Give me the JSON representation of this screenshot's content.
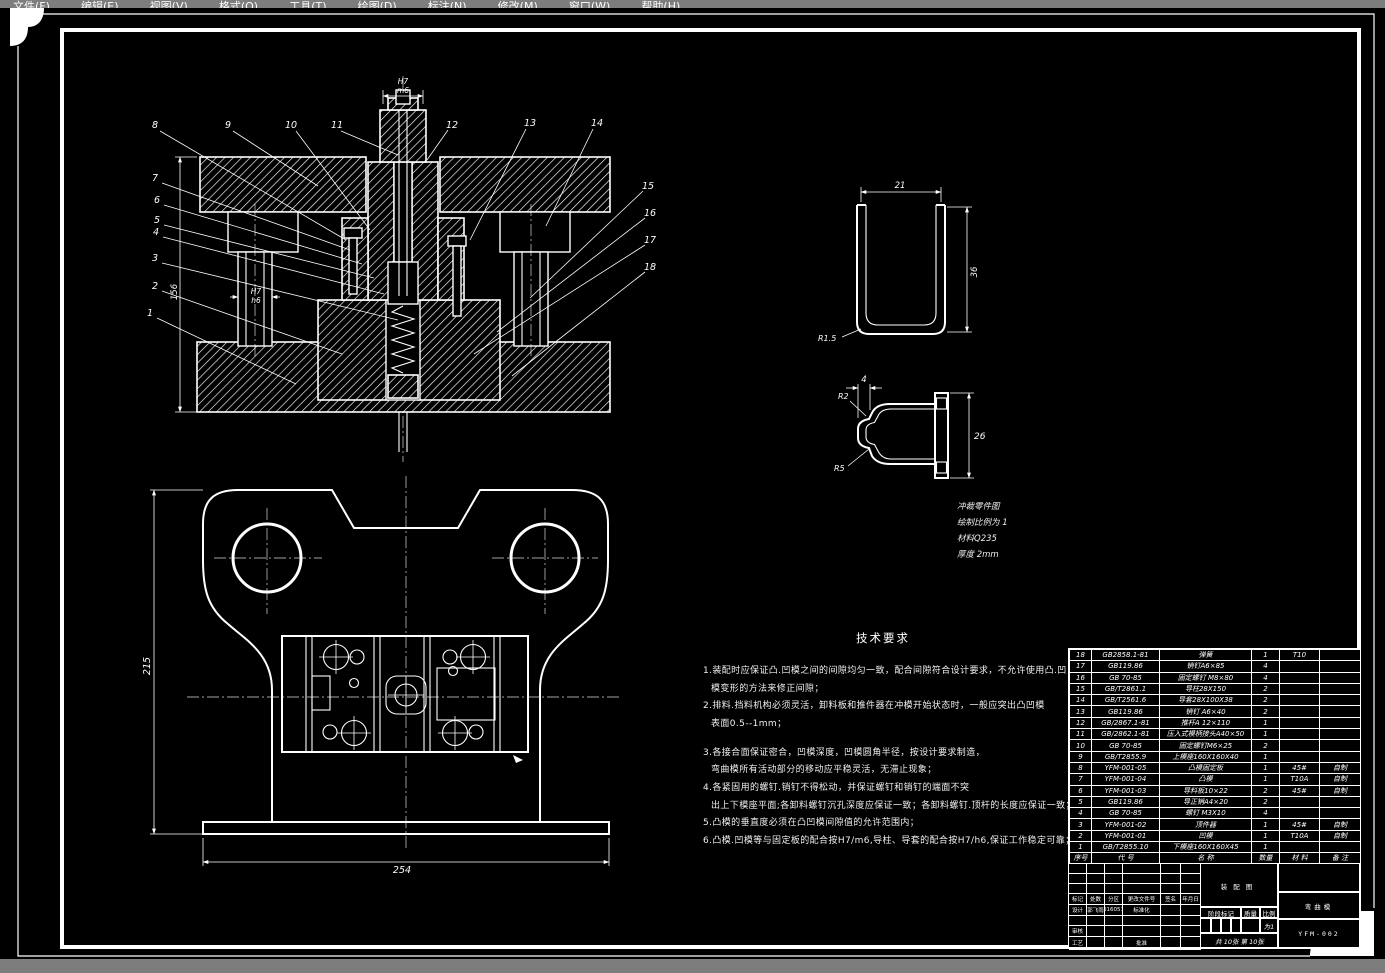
{
  "menu": {
    "items": [
      "文件(F)",
      "编辑(E)",
      "视图(V)",
      "格式(O)",
      "工具(T)",
      "绘图(D)",
      "标注(N)",
      "修改(M)",
      "窗口(W)",
      "帮助(H)"
    ]
  },
  "section_view": {
    "balloons": [
      "1",
      "2",
      "3",
      "4",
      "5",
      "6",
      "7",
      "8",
      "9",
      "10",
      "11",
      "12",
      "13",
      "14",
      "15",
      "16",
      "17",
      "18"
    ],
    "fit_shank_upper": "H7",
    "fit_shank_lower": "m6",
    "fit_pillar_upper": "H7",
    "fit_pillar_lower": "h6",
    "dim_height": "156"
  },
  "plan_view": {
    "dim_height": "215",
    "dim_width": "254"
  },
  "detail_channel": {
    "dim_width": "21",
    "dim_height": "36",
    "radius": "R1.5"
  },
  "detail_cap": {
    "dim_width": "4",
    "radius_top": "R2",
    "radius_bottom": "R5",
    "dim_height": "26"
  },
  "detail_notes": {
    "line1": "冲裁零件图",
    "line2": "绘制比例为 1",
    "line3": "材料Q235",
    "line4": "厚度 2mm"
  },
  "tech_requirements": {
    "title": "技术要求",
    "lines": [
      "1.装配时应保证凸.凹模之间的间隙均匀一致，配合间隙符合设计要求，不允许使用凸.凹",
      "模变形的方法来修正间隙；",
      "2.排料.挡料机构必须灵活，卸料板和推件器在冲模开始状态时，一般应突出凸凹模",
      "表面0.5--1mm；",
      "3.各接合面保证密合，凹模深度，凹模圆角半径，按设计要求制造，",
      "弯曲模所有活动部分的移动应平稳灵活，无滞止现象；",
      "4.各紧固用的螺钉.销钉不得松动，并保证螺钉和销钉的端面不突",
      "出上下模座平面;各卸料螺钉沉孔深度应保证一致；各卸料螺钉.顶杆的长度应保证一致；",
      "5.凸模的垂直度必须在凸凹模间隙值的允许范围内；",
      "6.凸模.凹模等与固定板的配合按H7/m6,导柱、导套的配合按H7/h6,保证工作稳定可靠；"
    ]
  },
  "bom": {
    "headers": {
      "seq": "序号",
      "code": "代  号",
      "name": "名  称",
      "qty": "数量",
      "material": "材  料",
      "note": "备  注"
    },
    "rows": [
      {
        "seq": "18",
        "code": "GB2858.1-81",
        "name": "弹簧",
        "qty": "1",
        "material": "T10",
        "note": ""
      },
      {
        "seq": "17",
        "code": "GB119.86",
        "name": "销钉A6×85",
        "qty": "4",
        "material": "",
        "note": ""
      },
      {
        "seq": "16",
        "code": "GB 70-85",
        "name": "固定螺钉 M8×80",
        "qty": "4",
        "material": "",
        "note": ""
      },
      {
        "seq": "15",
        "code": "GB/T2861.1",
        "name": "导柱28X150",
        "qty": "2",
        "material": "",
        "note": ""
      },
      {
        "seq": "14",
        "code": "GB/T2561.6",
        "name": "导套28X100X38",
        "qty": "2",
        "material": "",
        "note": ""
      },
      {
        "seq": "13",
        "code": "GB119.86",
        "name": "销钉 A6×40",
        "qty": "2",
        "material": "",
        "note": ""
      },
      {
        "seq": "12",
        "code": "GB/2867.1-81",
        "name": "推杆A 12×110",
        "qty": "1",
        "material": "",
        "note": ""
      },
      {
        "seq": "11",
        "code": "GB/2862.1-81",
        "name": "压入式模柄接头A40×50",
        "qty": "1",
        "material": "",
        "note": ""
      },
      {
        "seq": "10",
        "code": "GB 70-85",
        "name": "固定螺钉M6×25",
        "qty": "2",
        "material": "",
        "note": ""
      },
      {
        "seq": "9",
        "code": "GB/T2855.9",
        "name": "上模座160X160X40",
        "qty": "1",
        "material": "",
        "note": ""
      },
      {
        "seq": "8",
        "code": "YFM-001-05",
        "name": "凸模固定板",
        "qty": "1",
        "material": "45#",
        "note": "自制"
      },
      {
        "seq": "7",
        "code": "YFM-001-04",
        "name": "凸模",
        "qty": "1",
        "material": "T10A",
        "note": "自制"
      },
      {
        "seq": "6",
        "code": "YFM-001-03",
        "name": "导料板10×22",
        "qty": "2",
        "material": "45#",
        "note": "自制"
      },
      {
        "seq": "5",
        "code": "GB119.86",
        "name": "导正销A4×20",
        "qty": "2",
        "material": "",
        "note": ""
      },
      {
        "seq": "4",
        "code": "GB 70-85",
        "name": "螺钉 M3X10",
        "qty": "4",
        "material": "",
        "note": ""
      },
      {
        "seq": "3",
        "code": "YFM-001-02",
        "name": "顶件器",
        "qty": "1",
        "material": "45#",
        "note": "自制"
      },
      {
        "seq": "2",
        "code": "YFM-001-01",
        "name": "凹模",
        "qty": "1",
        "material": "T10A",
        "note": "自制"
      },
      {
        "seq": "1",
        "code": "GB/T2855.10",
        "name": "下模座160X160X45",
        "qty": "1",
        "material": "",
        "note": ""
      }
    ]
  },
  "title_block": {
    "title": "装配图",
    "product": "弯曲模",
    "drawing_no": "YFM-002",
    "cols": [
      "标记",
      "处数",
      "分区",
      "更改文件号",
      "签名",
      "年月日"
    ],
    "design_label": "设计",
    "designer": "郭飞雨",
    "date": "20160517",
    "standard_label": "标准化",
    "check_label": "审核",
    "process_label": "工艺",
    "approve_label": "批准",
    "stage_label": "阶段标记",
    "weight_label": "质量",
    "scale_label": "比例",
    "scale_value": "为1",
    "sheets": "共 10张 第 10张"
  }
}
